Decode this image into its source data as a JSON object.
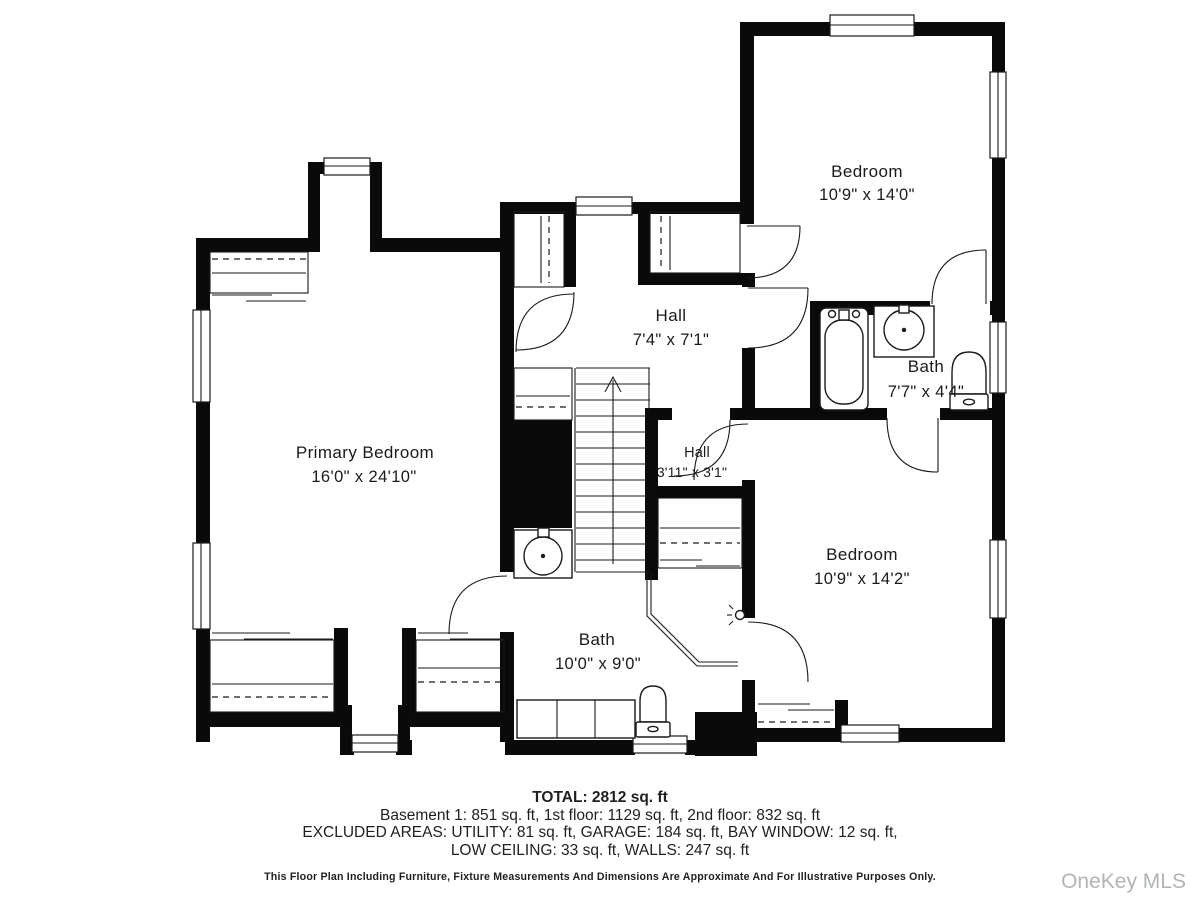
{
  "rooms": {
    "primary_bedroom": {
      "name": "Primary Bedroom",
      "dims": "16'0\" x 24'10\""
    },
    "bedroom_top_right": {
      "name": "Bedroom",
      "dims": "10'9\" x 14'0\""
    },
    "hall": {
      "name": "Hall",
      "dims": "7'4\" x 7'1\""
    },
    "hall_small": {
      "name": "Hall",
      "dims": "3'11\" x 3'1\""
    },
    "bath_right": {
      "name": "Bath",
      "dims": "7'7\" x 4'4\""
    },
    "bedroom_bottom_right": {
      "name": "Bedroom",
      "dims": "10'9\" x 14'2\""
    },
    "bath_bottom": {
      "name": "Bath",
      "dims": "10'0\" x 9'0\""
    }
  },
  "footer": {
    "total": "TOTAL: 2812 sq. ft",
    "floors": "Basement 1: 851 sq. ft, 1st floor: 1129 sq. ft, 2nd floor: 832 sq. ft",
    "excluded_line1": "EXCLUDED AREAS: UTILITY: 81 sq. ft, GARAGE: 184 sq. ft, BAY WINDOW: 12 sq. ft,",
    "excluded_line2": "LOW CEILING: 33 sq. ft, WALLS: 247 sq. ft",
    "disclaimer": "This Floor Plan Including Furniture, Fixture Measurements And Dimensions Are Approximate And For Illustrative Purposes Only."
  },
  "watermark": "OneKey MLS",
  "colors": {
    "background": "#ffffff",
    "wall": "#0a0a0a",
    "line": "#1a1a1a",
    "text": "#1a1a1a",
    "watermark": "#b1b4b7"
  }
}
